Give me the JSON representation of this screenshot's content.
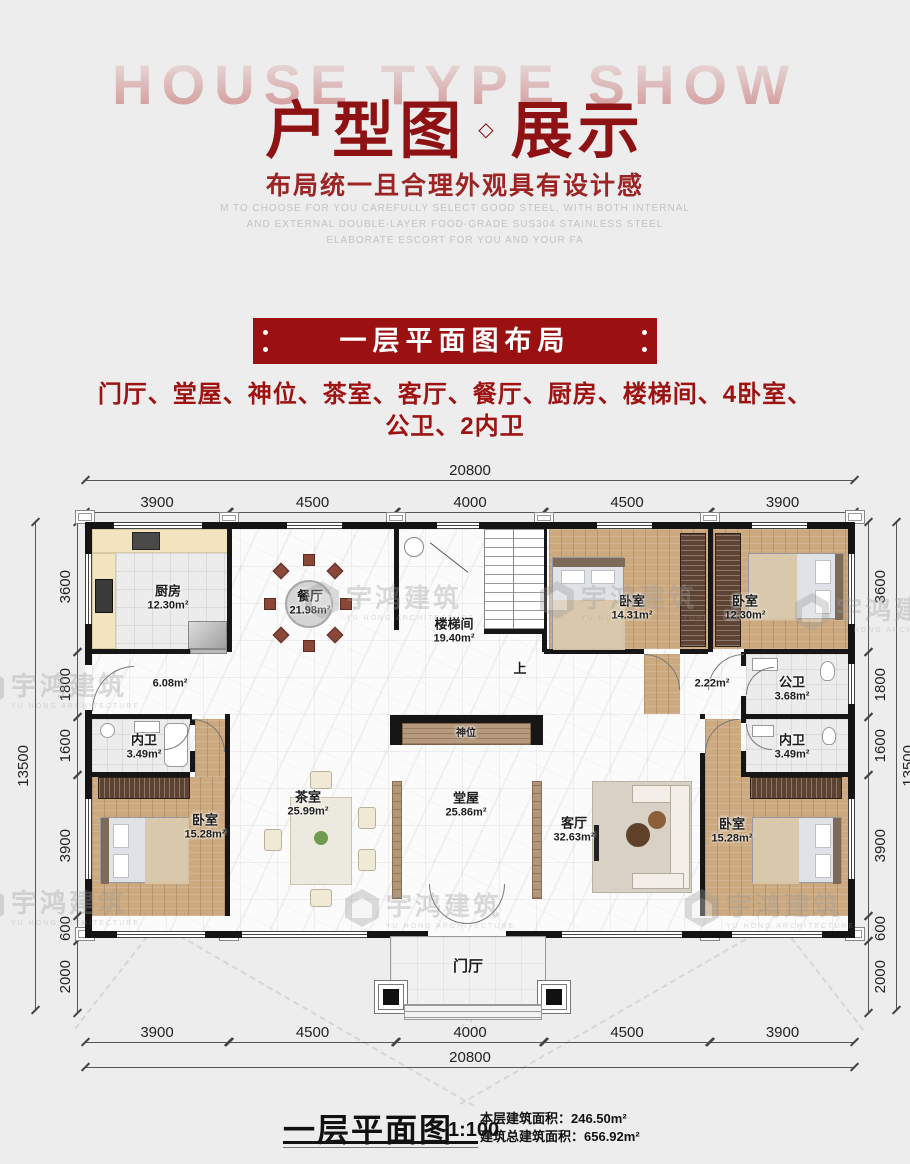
{
  "header": {
    "watermark_text": "HOUSE TYPE SHOW",
    "title": {
      "left": "户型图",
      "diamond": "◇",
      "right": "展示"
    },
    "subtitle": "布局统一且合理外观具有设计感",
    "description_lines": [
      "M TO CHOOSE FOR YOU CAREFULLY SELECT GOOD STEEL, WITH BOTH INTERNAL",
      "AND EXTERNAL DOUBLE-LAYER FOOD-GRADE SUS304 STAINLESS STEEL",
      "ELABORATE ESCORT FOR YOU AND YOUR FA"
    ]
  },
  "section_banner": {
    "title": "一层平面图布局"
  },
  "room_summary": {
    "line1": "门厅、堂屋、神位、茶室、客厅、餐厅、厨房、楼梯间、4卧室、",
    "line2": "公卫、2内卫"
  },
  "floor_plan": {
    "dimensions": {
      "top_total": "20800",
      "top_segments": [
        "3900",
        "4500",
        "4000",
        "4500",
        "3900"
      ],
      "bottom_segments": [
        "3900",
        "4500",
        "4000",
        "4500",
        "3900"
      ],
      "bottom_total": "20800",
      "left_total": "13500",
      "left_segments": [
        "3600",
        "1800",
        "1600",
        "3900",
        "600",
        "2000"
      ],
      "right_segments": [
        "3600",
        "1800",
        "1600",
        "3900",
        "600",
        "2000"
      ],
      "right_total": "13500"
    },
    "rooms": {
      "kitchen": {
        "name": "厨房",
        "area": "12.30m²"
      },
      "dining": {
        "name": "餐厅",
        "area": "21.98m²"
      },
      "stairwell": {
        "name": "楼梯间",
        "area": "19.40m²"
      },
      "bedroom_top_mid": {
        "name": "卧室",
        "area": "14.31m²"
      },
      "bedroom_top_right": {
        "name": "卧室",
        "area": "12.30m²"
      },
      "hall_left": {
        "area": "6.08m²"
      },
      "corridor_right": {
        "area": "2.22m²"
      },
      "bath_public": {
        "name": "公卫",
        "area": "3.68m²"
      },
      "bath_inner_left": {
        "name": "内卫",
        "area": "3.49m²"
      },
      "bath_inner_right": {
        "name": "内卫",
        "area": "3.49m²"
      },
      "bedroom_left": {
        "name": "卧室",
        "area": "15.28m²"
      },
      "tea_room": {
        "name": "茶室",
        "area": "25.99m²"
      },
      "main_hall": {
        "name": "堂屋",
        "area": "25.86m²"
      },
      "living_room": {
        "name": "客厅",
        "area": "32.63m²"
      },
      "bedroom_right": {
        "name": "卧室",
        "area": "15.28m²"
      },
      "altar": {
        "name": "神位"
      },
      "entrance": {
        "name": "门厅"
      }
    },
    "stair_up_label": "上"
  },
  "caption": {
    "title": "一层平面图",
    "scale": "1:100",
    "floor_area_line": "本层建筑面积：246.50m²",
    "total_area_line": "建筑总建筑面积：656.92m²"
  },
  "watermark": {
    "cn": "宇鸿建筑",
    "en": "YU HONG ARCHITECTURE"
  },
  "colors": {
    "accent_red": "#9b1111",
    "title_red": "#8e1113",
    "wall_black": "#161616"
  }
}
